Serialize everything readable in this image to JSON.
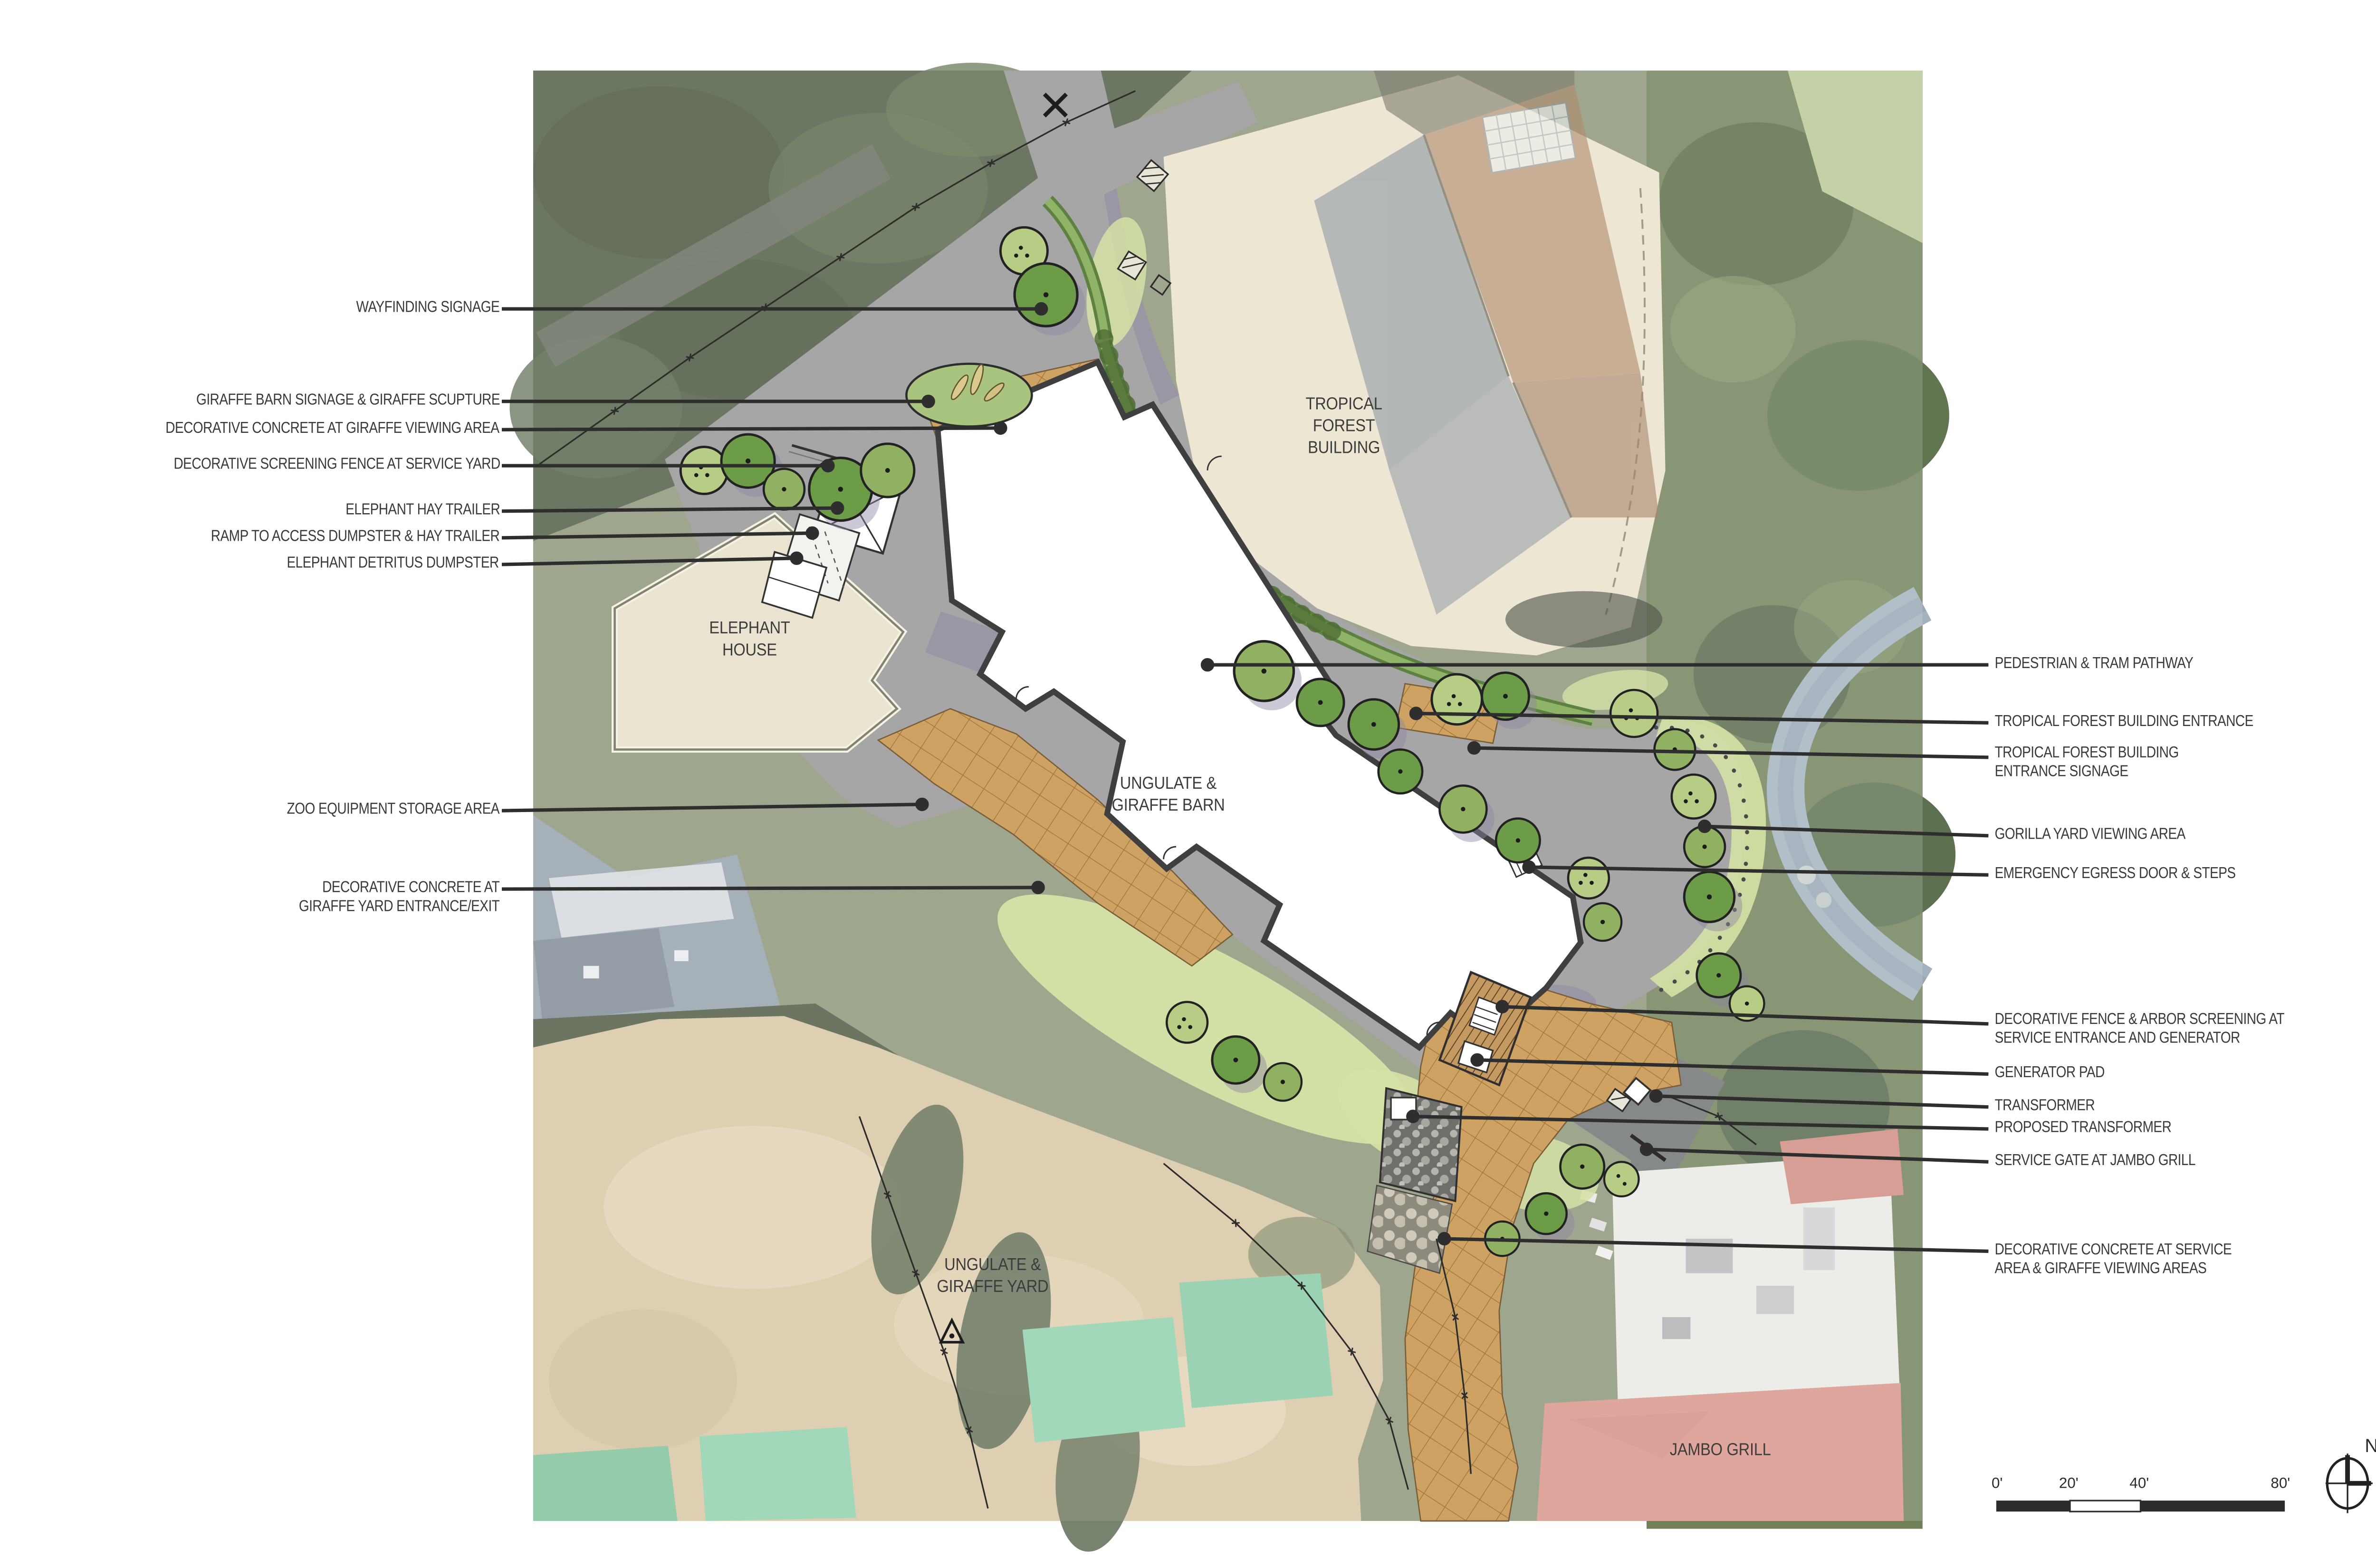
{
  "plan": {
    "area_labels": {
      "tropical_forest_building": "TROPICAL\nFOREST\nBUILDING",
      "elephant_house": "ELEPHANT\nHOUSE",
      "ungulate_giraffe_barn": "UNGULATE &\nGIRAFFE BARN",
      "ungulate_giraffe_yard": "UNGULATE &\nGIRAFFE YARD",
      "jambo_grill": "JAMBO GRILL"
    },
    "callouts_left": [
      {
        "label": "WAYFINDING SIGNAGE"
      },
      {
        "label": "GIRAFFE BARN SIGNAGE & GIRAFFE SCUPTURE"
      },
      {
        "label": "DECORATIVE CONCRETE AT GIRAFFE VIEWING AREA"
      },
      {
        "label": "DECORATIVE SCREENING FENCE AT SERVICE YARD"
      },
      {
        "label": "ELEPHANT HAY TRAILER"
      },
      {
        "label": "RAMP TO ACCESS DUMPSTER & HAY TRAILER"
      },
      {
        "label": "ELEPHANT DETRITUS DUMPSTER"
      },
      {
        "label": "ZOO EQUIPMENT STORAGE AREA"
      },
      {
        "label": "DECORATIVE CONCRETE  AT\nGIRAFFE YARD ENTRANCE/EXIT"
      }
    ],
    "callouts_right": [
      {
        "label": "PEDESTRIAN & TRAM PATHWAY"
      },
      {
        "label": "TROPICAL FOREST BUILDING ENTRANCE"
      },
      {
        "label": "TROPICAL FOREST BUILDING\nENTRANCE SIGNAGE"
      },
      {
        "label": "GORILLA YARD VIEWING AREA"
      },
      {
        "label": "EMERGENCY EGRESS DOOR & STEPS"
      },
      {
        "label": "DECORATIVE FENCE & ARBOR SCREENING AT\nSERVICE ENTRANCE AND GENERATOR"
      },
      {
        "label": "GENERATOR PAD"
      },
      {
        "label": "TRANSFORMER"
      },
      {
        "label": "PROPOSED TRANSFORMER"
      },
      {
        "label": "SERVICE GATE AT JAMBO GRILL"
      },
      {
        "label": "DECORATIVE CONCRETE AT SERVICE\nAREA & GIRAFFE VIEWING AREAS"
      }
    ],
    "scale_bar": {
      "tick0": "0'",
      "tick20": "20'",
      "tick40": "40'",
      "tick80": "80'"
    },
    "north_label": "N",
    "colors": {
      "new_concrete_gray": "#a6a6a6",
      "decorative_concrete_tan": "#cda263",
      "plaza_beige": "#ede6d2",
      "barn_white": "#ffffff",
      "lawn_green": "#d5e2a6",
      "tree_dark": "#6d9c49",
      "tree_light": "#b7cd85",
      "jambo_roof_red": "#d9958b",
      "label_text": "#3a3a3a"
    }
  }
}
